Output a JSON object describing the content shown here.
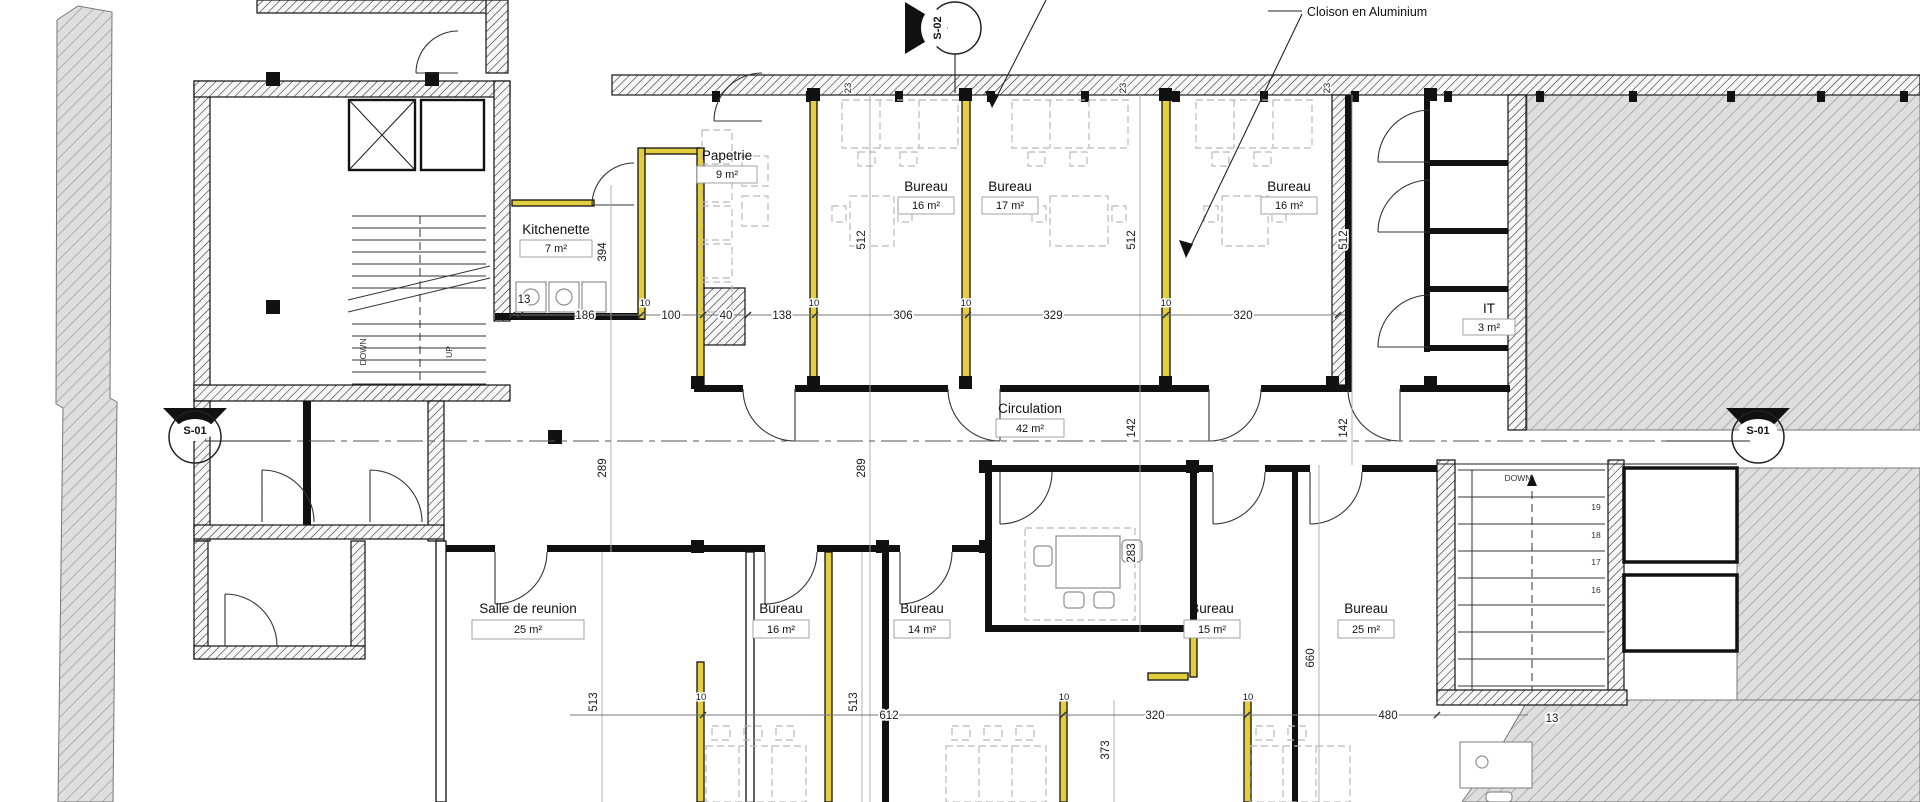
{
  "annotation": {
    "cloison": "Cloison en Aluminium"
  },
  "markers": {
    "s01": "S-01",
    "s02": "S-02"
  },
  "rooms": {
    "papetrie": {
      "name": "Papetrie",
      "area": "9 m²"
    },
    "kitchenette": {
      "name": "Kitchenette",
      "area": "7 m²"
    },
    "bureau_top_1": {
      "name": "Bureau",
      "area": "16 m²"
    },
    "bureau_top_2": {
      "name": "Bureau",
      "area": "17 m²"
    },
    "bureau_top_3": {
      "name": "Bureau",
      "area": "16 m²"
    },
    "it": {
      "name": "IT",
      "area": "3 m²"
    },
    "circulation": {
      "name": "Circulation",
      "area": "42 m²"
    },
    "salle": {
      "name": "Salle de reunion",
      "area": "25 m²"
    },
    "bureau_bottom_1": {
      "name": "Bureau",
      "area": "16 m²"
    },
    "bureau_bottom_2": {
      "name": "Bureau",
      "area": "14 m²"
    },
    "bureau_bottom_3": {
      "name": "Bureau",
      "area": "15 m²"
    },
    "bureau_bottom_4": {
      "name": "Bureau",
      "area": "25 m²"
    }
  },
  "dimensions": {
    "mid": [
      "13",
      "186",
      "100",
      "40",
      "138",
      "306",
      "329",
      "320"
    ],
    "bottom": [
      "612",
      "320",
      "480"
    ],
    "vertical": [
      "394",
      "512",
      "512",
      "512",
      "289",
      "289",
      "142",
      "142",
      "283",
      "660",
      "513",
      "513",
      "373"
    ],
    "stair_offset": "13",
    "wall_thickness": "10",
    "column_tick": "23"
  },
  "stairs": {
    "down": "DOWN",
    "up": "UP",
    "treads": [
      "19",
      "18",
      "17",
      "16"
    ]
  },
  "colors": {
    "aluminium_partition": "#E2CE3E",
    "area_hatch_bg": "#DEDEDE",
    "wall_line": "#111111"
  }
}
